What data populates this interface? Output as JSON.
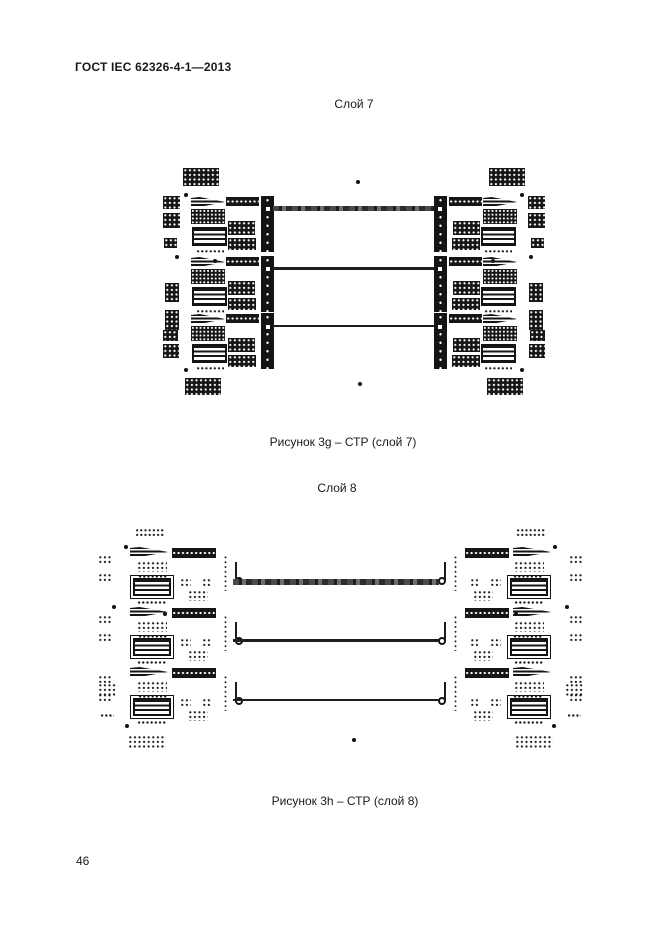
{
  "page": {
    "header": "ГОСТ IEC 62326-4-1—2013",
    "page_number": "46"
  },
  "figures": [
    {
      "title": "Слой 7",
      "caption": "Рисунок 3g – СТР (слой 7)"
    },
    {
      "title": "Слой 8",
      "caption": "Рисунок 3h – СТР (слой 8)"
    }
  ],
  "colors": {
    "ink": "#1a1a1a",
    "paper": "#ffffff"
  }
}
